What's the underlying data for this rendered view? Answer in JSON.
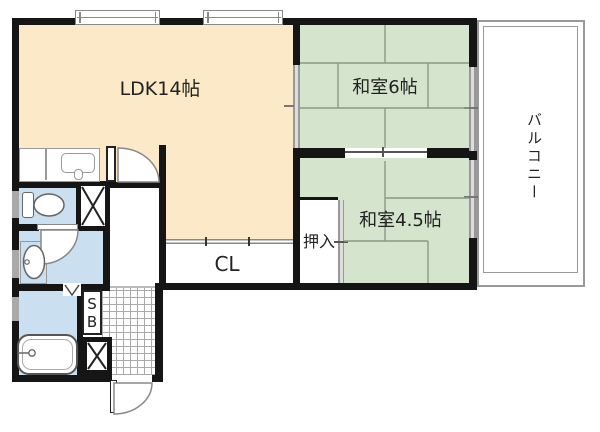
{
  "labels": {
    "ldk": "LDK14帖",
    "japanese_room_6": "和室6帖",
    "japanese_room_4_5": "和室4.5帖",
    "closet_cl": "CL",
    "oshiire": "押入",
    "shoe_box_line1": "S",
    "shoe_box_line2": "B",
    "balcony": "バルコニー"
  },
  "colors": {
    "ldk-fill": "#fbe9c8",
    "tatami-fill": "#d5e5cd",
    "wet-fill": "#cadff0",
    "wall": "#151515",
    "thin-line": "#999999",
    "tatami-line": "#8a9a84",
    "opening-gray": "#a9a9a9",
    "text": "#222222"
  }
}
